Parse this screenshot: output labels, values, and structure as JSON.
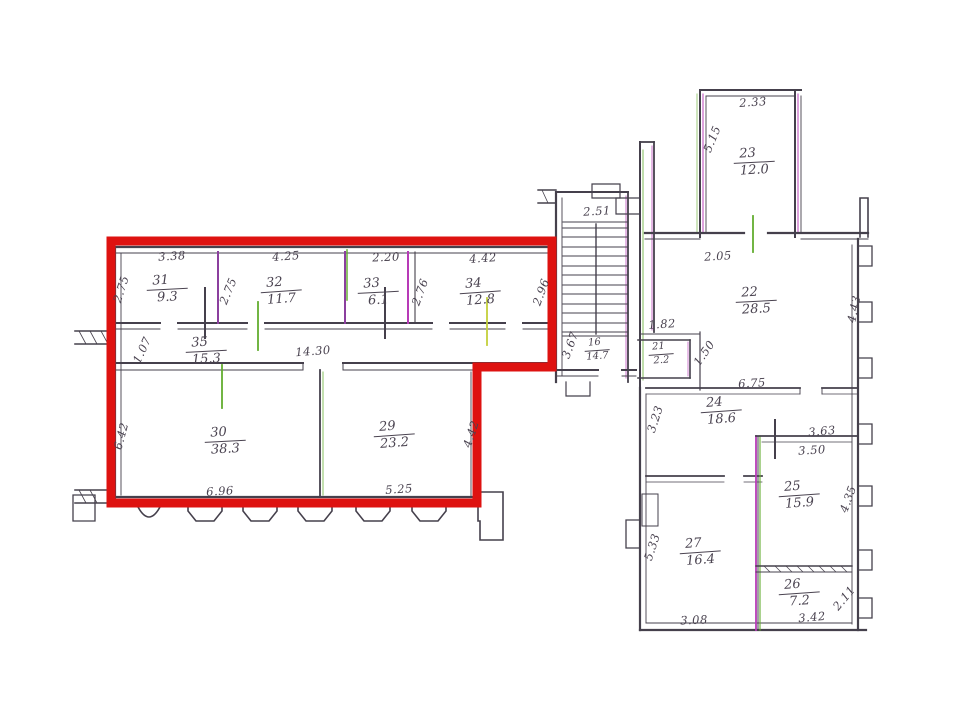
{
  "plan": {
    "type": "scanned-architectural-floor-plan",
    "palette": {
      "ink": "#45404c",
      "partition_purple": "#8b3f9e",
      "fringe_magenta": "#b73ab7",
      "fringe_green": "#63ad2f",
      "fringe_yellow_green": "#c3cf3a",
      "highlight_red": "#de1210",
      "paper": "#ffffff"
    },
    "highlight": {
      "meaning": "selected-unit-outline",
      "color": "#de1210"
    },
    "rooms": [
      {
        "number": "31",
        "area": "9.3"
      },
      {
        "number": "32",
        "area": "11.7"
      },
      {
        "number": "33",
        "area": "6.1"
      },
      {
        "number": "34",
        "area": "12.8"
      },
      {
        "number": "35",
        "area": "15.3"
      },
      {
        "number": "30",
        "area": "38.3"
      },
      {
        "number": "29",
        "area": "23.2"
      },
      {
        "number": "16",
        "area": "14.7"
      },
      {
        "number": "21",
        "area": "2.2"
      },
      {
        "number": "23",
        "area": "12.0"
      },
      {
        "number": "22",
        "area": "28.5"
      },
      {
        "number": "24",
        "area": "18.6"
      },
      {
        "number": "25",
        "area": "15.9"
      },
      {
        "number": "27",
        "area": "16.4"
      },
      {
        "number": "26",
        "area": "7.2"
      }
    ],
    "dims": [
      {
        "value": "3.38"
      },
      {
        "value": "4.25"
      },
      {
        "value": "2.20"
      },
      {
        "value": "4.42"
      },
      {
        "value": "2.75"
      },
      {
        "value": "2.75"
      },
      {
        "value": "2.76"
      },
      {
        "value": "2.96"
      },
      {
        "value": "14.30"
      },
      {
        "value": "1.07"
      },
      {
        "value": "6.96"
      },
      {
        "value": "5.25"
      },
      {
        "value": "6.42"
      },
      {
        "value": "4.42"
      },
      {
        "value": "2.51"
      },
      {
        "value": "3.67"
      },
      {
        "value": "1.82"
      },
      {
        "value": "1.50"
      },
      {
        "value": "2.33"
      },
      {
        "value": "5.15"
      },
      {
        "value": "2.05"
      },
      {
        "value": "4.43"
      },
      {
        "value": "6.75"
      },
      {
        "value": "3.23"
      },
      {
        "value": "3.63"
      },
      {
        "value": "3.50"
      },
      {
        "value": "4.35"
      },
      {
        "value": "5.33"
      },
      {
        "value": "3.08"
      },
      {
        "value": "3.42"
      },
      {
        "value": "2.11"
      }
    ]
  }
}
